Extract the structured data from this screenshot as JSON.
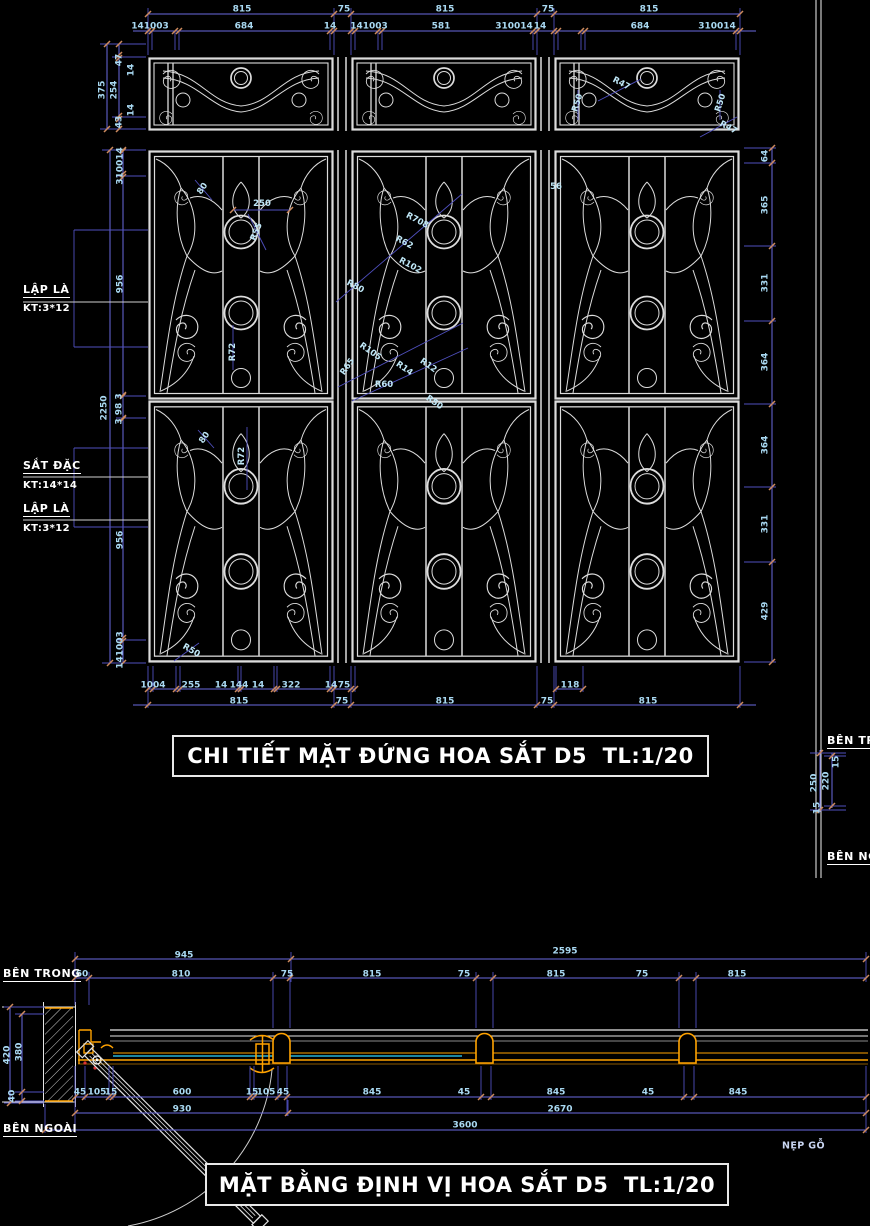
{
  "titles": {
    "elevation": "CHI TIẾT MẶT ĐỨNG HOA SẮT D5  TL:1/20",
    "plan": "MẶT BẰNG ĐỊNH VỊ HOA SẮT D5  TL:1/20"
  },
  "colors": {
    "background": "#000000",
    "drawing_line": "#dcdcdc",
    "dimension_line": "#6a6ae0",
    "extension_line": "#4f4fbe",
    "dimension_text": "#a9d9f2",
    "tick": "#cd8a5e",
    "frame_orange": "#ffa200",
    "glass_cyan": "#2fd5ff",
    "label_white": "#ffffff"
  },
  "annotations": [
    {
      "t": "815",
      "x": 242,
      "y": 10
    },
    {
      "t": "75",
      "x": 344,
      "y": 10
    },
    {
      "t": "815",
      "x": 445,
      "y": 10
    },
    {
      "t": "75",
      "x": 548,
      "y": 10
    },
    {
      "t": "815",
      "x": 649,
      "y": 10
    },
    {
      "t": "141003",
      "x": 150,
      "y": 27
    },
    {
      "t": "684",
      "x": 244,
      "y": 27
    },
    {
      "t": "14",
      "x": 330,
      "y": 27
    },
    {
      "t": "141003",
      "x": 369,
      "y": 27
    },
    {
      "t": "581",
      "x": 441,
      "y": 27
    },
    {
      "t": "310014",
      "x": 514,
      "y": 27
    },
    {
      "t": "14",
      "x": 540,
      "y": 27
    },
    {
      "t": "684",
      "x": 640,
      "y": 27
    },
    {
      "t": "310014",
      "x": 717,
      "y": 27
    },
    {
      "t": "47",
      "x": 120,
      "y": 60,
      "r": -90
    },
    {
      "t": "14",
      "x": 132,
      "y": 70,
      "r": -90
    },
    {
      "t": "375",
      "x": 103,
      "y": 90,
      "r": -90
    },
    {
      "t": "254",
      "x": 115,
      "y": 90,
      "r": -90
    },
    {
      "t": "14",
      "x": 132,
      "y": 110,
      "r": -90
    },
    {
      "t": "43",
      "x": 120,
      "y": 122,
      "r": -90
    },
    {
      "t": "310014",
      "x": 121,
      "y": 166,
      "r": -90
    },
    {
      "t": "956",
      "x": 121,
      "y": 284,
      "r": -90
    },
    {
      "t": "2250",
      "x": 105,
      "y": 408,
      "r": -90
    },
    {
      "t": "3 98 3",
      "x": 120,
      "y": 409,
      "r": -90
    },
    {
      "t": "956",
      "x": 121,
      "y": 540,
      "r": -90
    },
    {
      "t": "141003",
      "x": 121,
      "y": 650,
      "r": -90
    },
    {
      "t": "LẬP LÀ",
      "x": 23,
      "y": 291,
      "c": "wl",
      "n": "lap-la-label"
    },
    {
      "t": "KT:3*12",
      "x": 23,
      "y": 309,
      "c": "wk",
      "n": "kt-3x12-label"
    },
    {
      "t": "SẮT ĐẶC",
      "x": 23,
      "y": 467,
      "c": "wl",
      "n": "sat-dac-label"
    },
    {
      "t": "KT:14*14",
      "x": 23,
      "y": 486,
      "c": "wk",
      "n": "kt-14x14-label"
    },
    {
      "t": "LẬP LÀ",
      "x": 23,
      "y": 510,
      "c": "wl",
      "n": "lap-la-label"
    },
    {
      "t": "KT:3*12",
      "x": 23,
      "y": 529,
      "c": "wk",
      "n": "kt-3x12-label"
    },
    {
      "t": "64",
      "x": 766,
      "y": 156,
      "r": -90
    },
    {
      "t": "365",
      "x": 766,
      "y": 205,
      "r": -90
    },
    {
      "t": "331",
      "x": 766,
      "y": 283,
      "r": -90
    },
    {
      "t": "364",
      "x": 766,
      "y": 362,
      "r": -90
    },
    {
      "t": "364",
      "x": 766,
      "y": 445,
      "r": -90
    },
    {
      "t": "331",
      "x": 766,
      "y": 524,
      "r": -90
    },
    {
      "t": "429",
      "x": 766,
      "y": 611,
      "r": -90
    },
    {
      "t": "1004",
      "x": 153,
      "y": 686
    },
    {
      "t": "255",
      "x": 191,
      "y": 686
    },
    {
      "t": "14",
      "x": 221,
      "y": 686
    },
    {
      "t": "144",
      "x": 239,
      "y": 686
    },
    {
      "t": "14",
      "x": 258,
      "y": 686
    },
    {
      "t": "322",
      "x": 291,
      "y": 686
    },
    {
      "t": "14",
      "x": 331,
      "y": 686
    },
    {
      "t": "75",
      "x": 344,
      "y": 686
    },
    {
      "t": "118",
      "x": 570,
      "y": 686
    },
    {
      "t": "815",
      "x": 239,
      "y": 702
    },
    {
      "t": "75",
      "x": 342,
      "y": 702
    },
    {
      "t": "815",
      "x": 445,
      "y": 702
    },
    {
      "t": "75",
      "x": 547,
      "y": 702
    },
    {
      "t": "815",
      "x": 648,
      "y": 702
    },
    {
      "t": "R50",
      "x": 578,
      "y": 103,
      "r": -72,
      "c": "call"
    },
    {
      "t": "R47",
      "x": 621,
      "y": 84,
      "r": 28,
      "c": "call"
    },
    {
      "t": "R50",
      "x": 721,
      "y": 103,
      "r": -72,
      "c": "call"
    },
    {
      "t": "R47",
      "x": 728,
      "y": 128,
      "r": 28,
      "c": "call"
    },
    {
      "t": "80",
      "x": 203,
      "y": 189,
      "r": -55,
      "c": "call"
    },
    {
      "t": "250",
      "x": 262,
      "y": 204,
      "c": "call"
    },
    {
      "t": "R55",
      "x": 257,
      "y": 232,
      "r": -68,
      "c": "call"
    },
    {
      "t": "R72",
      "x": 233,
      "y": 352,
      "r": -90,
      "c": "call"
    },
    {
      "t": "R80",
      "x": 355,
      "y": 287,
      "r": 28,
      "c": "call"
    },
    {
      "t": "R708",
      "x": 417,
      "y": 221,
      "r": 28,
      "c": "call"
    },
    {
      "t": "R62",
      "x": 404,
      "y": 243,
      "r": 28,
      "c": "call"
    },
    {
      "t": "R102",
      "x": 410,
      "y": 266,
      "r": 28,
      "c": "call"
    },
    {
      "t": "56",
      "x": 556,
      "y": 187,
      "c": "call"
    },
    {
      "t": "R105",
      "x": 370,
      "y": 352,
      "r": 35,
      "c": "call"
    },
    {
      "t": "R65",
      "x": 348,
      "y": 367,
      "r": -55,
      "c": "call"
    },
    {
      "t": "R14",
      "x": 404,
      "y": 369,
      "r": 35,
      "c": "call"
    },
    {
      "t": "R12",
      "x": 428,
      "y": 366,
      "r": 35,
      "c": "call"
    },
    {
      "t": "R60",
      "x": 384,
      "y": 385,
      "c": "call"
    },
    {
      "t": "R50",
      "x": 434,
      "y": 403,
      "r": 35,
      "c": "call"
    },
    {
      "t": "80",
      "x": 205,
      "y": 438,
      "r": -55,
      "c": "call"
    },
    {
      "t": "R72",
      "x": 242,
      "y": 456,
      "r": -90,
      "c": "call"
    },
    {
      "t": "R50",
      "x": 191,
      "y": 651,
      "r": 30,
      "c": "call"
    },
    {
      "t": "945",
      "x": 184,
      "y": 956
    },
    {
      "t": "2595",
      "x": 565,
      "y": 952
    },
    {
      "t": "60",
      "x": 82,
      "y": 975
    },
    {
      "t": "810",
      "x": 181,
      "y": 975
    },
    {
      "t": "75",
      "x": 287,
      "y": 975
    },
    {
      "t": "815",
      "x": 372,
      "y": 975
    },
    {
      "t": "75",
      "x": 464,
      "y": 975
    },
    {
      "t": "815",
      "x": 556,
      "y": 975
    },
    {
      "t": "75",
      "x": 642,
      "y": 975
    },
    {
      "t": "815",
      "x": 737,
      "y": 975
    },
    {
      "t": "420",
      "x": 8,
      "y": 1055,
      "r": -90
    },
    {
      "t": "380",
      "x": 20,
      "y": 1052,
      "r": -90
    },
    {
      "t": "40",
      "x": 13,
      "y": 1096,
      "r": -90
    },
    {
      "t": "45",
      "x": 80,
      "y": 1093
    },
    {
      "t": "105",
      "x": 97,
      "y": 1093
    },
    {
      "t": "15",
      "x": 111,
      "y": 1093
    },
    {
      "t": "600",
      "x": 182,
      "y": 1093
    },
    {
      "t": "15",
      "x": 252,
      "y": 1093
    },
    {
      "t": "105",
      "x": 266,
      "y": 1093
    },
    {
      "t": "45",
      "x": 283,
      "y": 1093
    },
    {
      "t": "845",
      "x": 372,
      "y": 1093
    },
    {
      "t": "45",
      "x": 464,
      "y": 1093
    },
    {
      "t": "845",
      "x": 556,
      "y": 1093
    },
    {
      "t": "45",
      "x": 648,
      "y": 1093
    },
    {
      "t": "845",
      "x": 738,
      "y": 1093
    },
    {
      "t": "930",
      "x": 182,
      "y": 1110
    },
    {
      "t": "2670",
      "x": 560,
      "y": 1110
    },
    {
      "t": "3600",
      "x": 465,
      "y": 1126
    },
    {
      "t": "BÊN TRONG",
      "x": 3,
      "y": 975,
      "c": "wl",
      "n": "ben-trong-label"
    },
    {
      "t": "BÊN NGOÀI",
      "x": 3,
      "y": 1130,
      "c": "wl",
      "n": "ben-ngoai-label"
    },
    {
      "t": "NẸP GỖ",
      "x": 782,
      "y": 1146,
      "c": "wn",
      "n": "nep-go-label"
    },
    {
      "t": "BÊN TRONG",
      "x": 827,
      "y": 742,
      "c": "wl",
      "n": "ben-trong-label"
    },
    {
      "t": "BÊN NGOÀI",
      "x": 827,
      "y": 858,
      "c": "wl",
      "n": "ben-ngoai-label"
    },
    {
      "t": "250",
      "x": 815,
      "y": 783,
      "r": -90
    },
    {
      "t": "220",
      "x": 827,
      "y": 781,
      "r": -90
    },
    {
      "t": "15",
      "x": 837,
      "y": 762,
      "r": -90
    },
    {
      "t": "15",
      "x": 818,
      "y": 808,
      "r": -90
    }
  ]
}
